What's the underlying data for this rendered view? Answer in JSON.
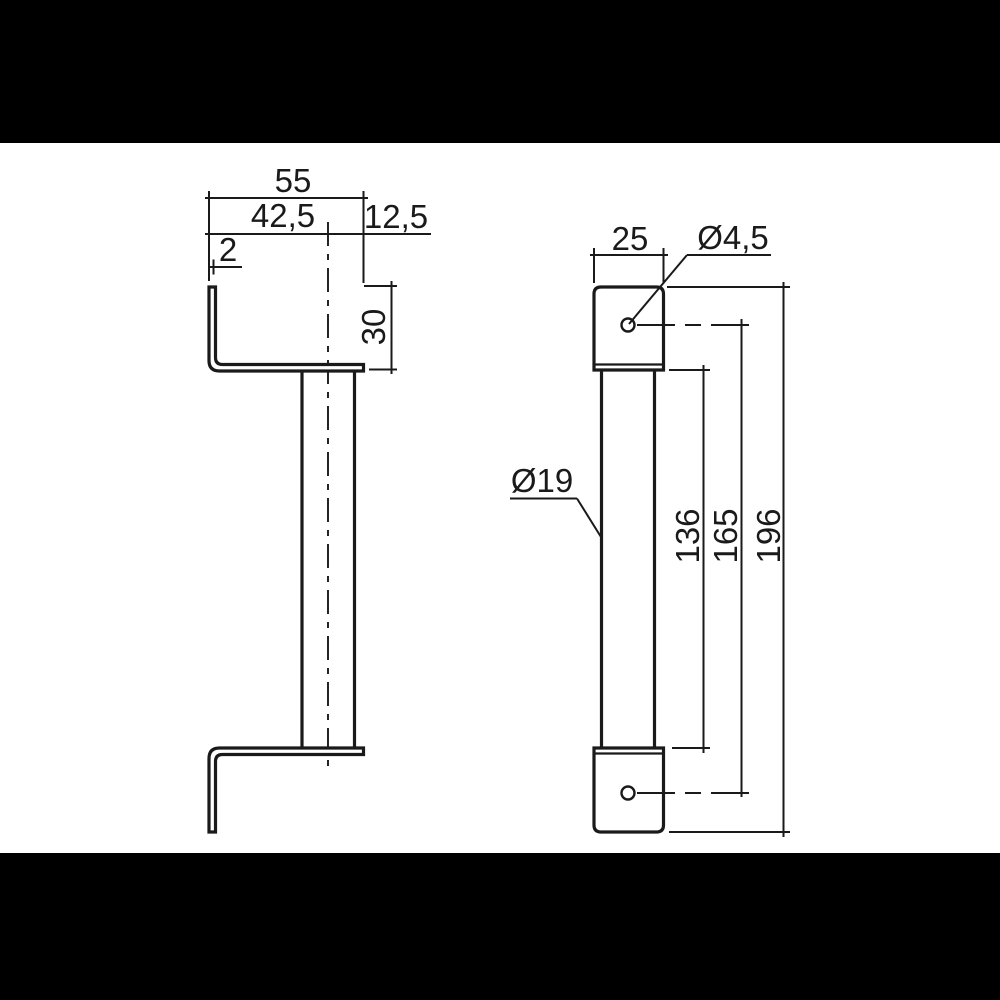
{
  "drawing": {
    "type": "technical-drawing",
    "part": "handle-with-end-brackets",
    "colors": {
      "line": "#1a1a1a",
      "background": "#ffffff",
      "letterbox": "#000000"
    },
    "views": {
      "side_view": {
        "dims": {
          "overall_width": "55",
          "center_offset": "42,5",
          "right_offset": "12,5",
          "sheet_thickness": "2",
          "bracket_height": "30"
        }
      },
      "front_view": {
        "dims": {
          "block_width": "25",
          "hole_diameter": "Ø4,5",
          "bar_diameter": "Ø19",
          "bar_length": "136",
          "hole_spacing": "165",
          "overall_height": "196"
        }
      }
    }
  }
}
